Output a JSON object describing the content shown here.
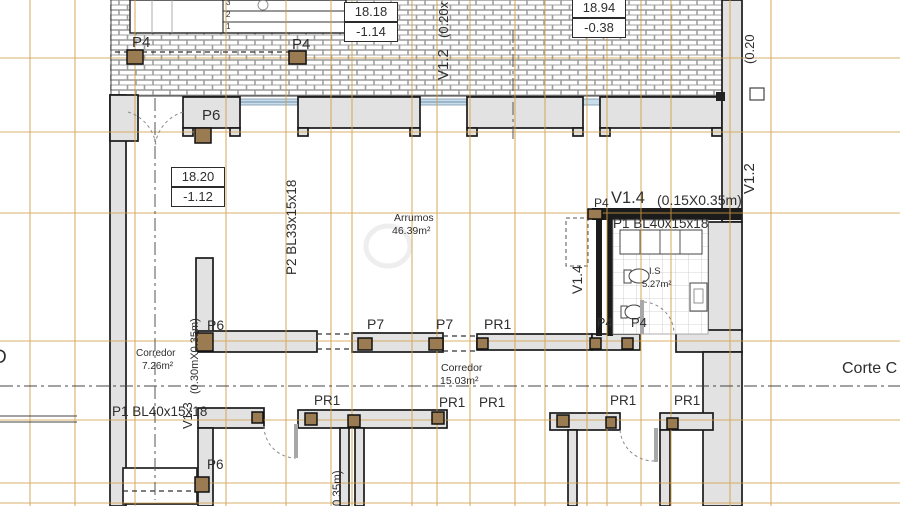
{
  "title": "Structural floor plan",
  "colors": {
    "grid": "#D29E45",
    "wall": "#E2E2E2",
    "wall_dark": "#1B1B1B",
    "column": "#9B7B52",
    "glazing": "#C9DEED"
  },
  "levels": {
    "b1": {
      "elevation": "18.18",
      "offset": "-1.14"
    },
    "b2": {
      "elevation": "18.94",
      "offset": "-0.38"
    },
    "b3": {
      "elevation": "18.20",
      "offset": "-1.12"
    }
  },
  "stairs": {
    "s1": "1",
    "s2": "2",
    "s3": "3"
  },
  "marks": {
    "p4": "P4",
    "p6": "P6",
    "p7": "P7",
    "pr1": "PR1"
  },
  "beams": {
    "p2_beam": "P2 BL33x15x18",
    "p1_beam": "P1 BL40x15x18"
  },
  "windows": {
    "v12": "V1.2",
    "v12_dim_left": "(0.20x",
    "v12_dim_right": "(0.20",
    "v14": "V1.4",
    "v14_dim": "(0.15X0.35m)",
    "v13": "V1.3",
    "v13_dim": "(0.30mX0.35m)",
    "v_bottom_dim": "(0.35m)"
  },
  "rooms": {
    "arrumos": {
      "name": "Arrumos",
      "area": "46.39m²"
    },
    "corredor1": {
      "name": "Corredor",
      "area": "7.26m²"
    },
    "corredor2": {
      "name": "Corredor",
      "area": "15.03m²"
    },
    "is": {
      "name": "I.S",
      "area": "5.27m²"
    }
  },
  "sections": {
    "left": "D",
    "right": "Corte C"
  }
}
